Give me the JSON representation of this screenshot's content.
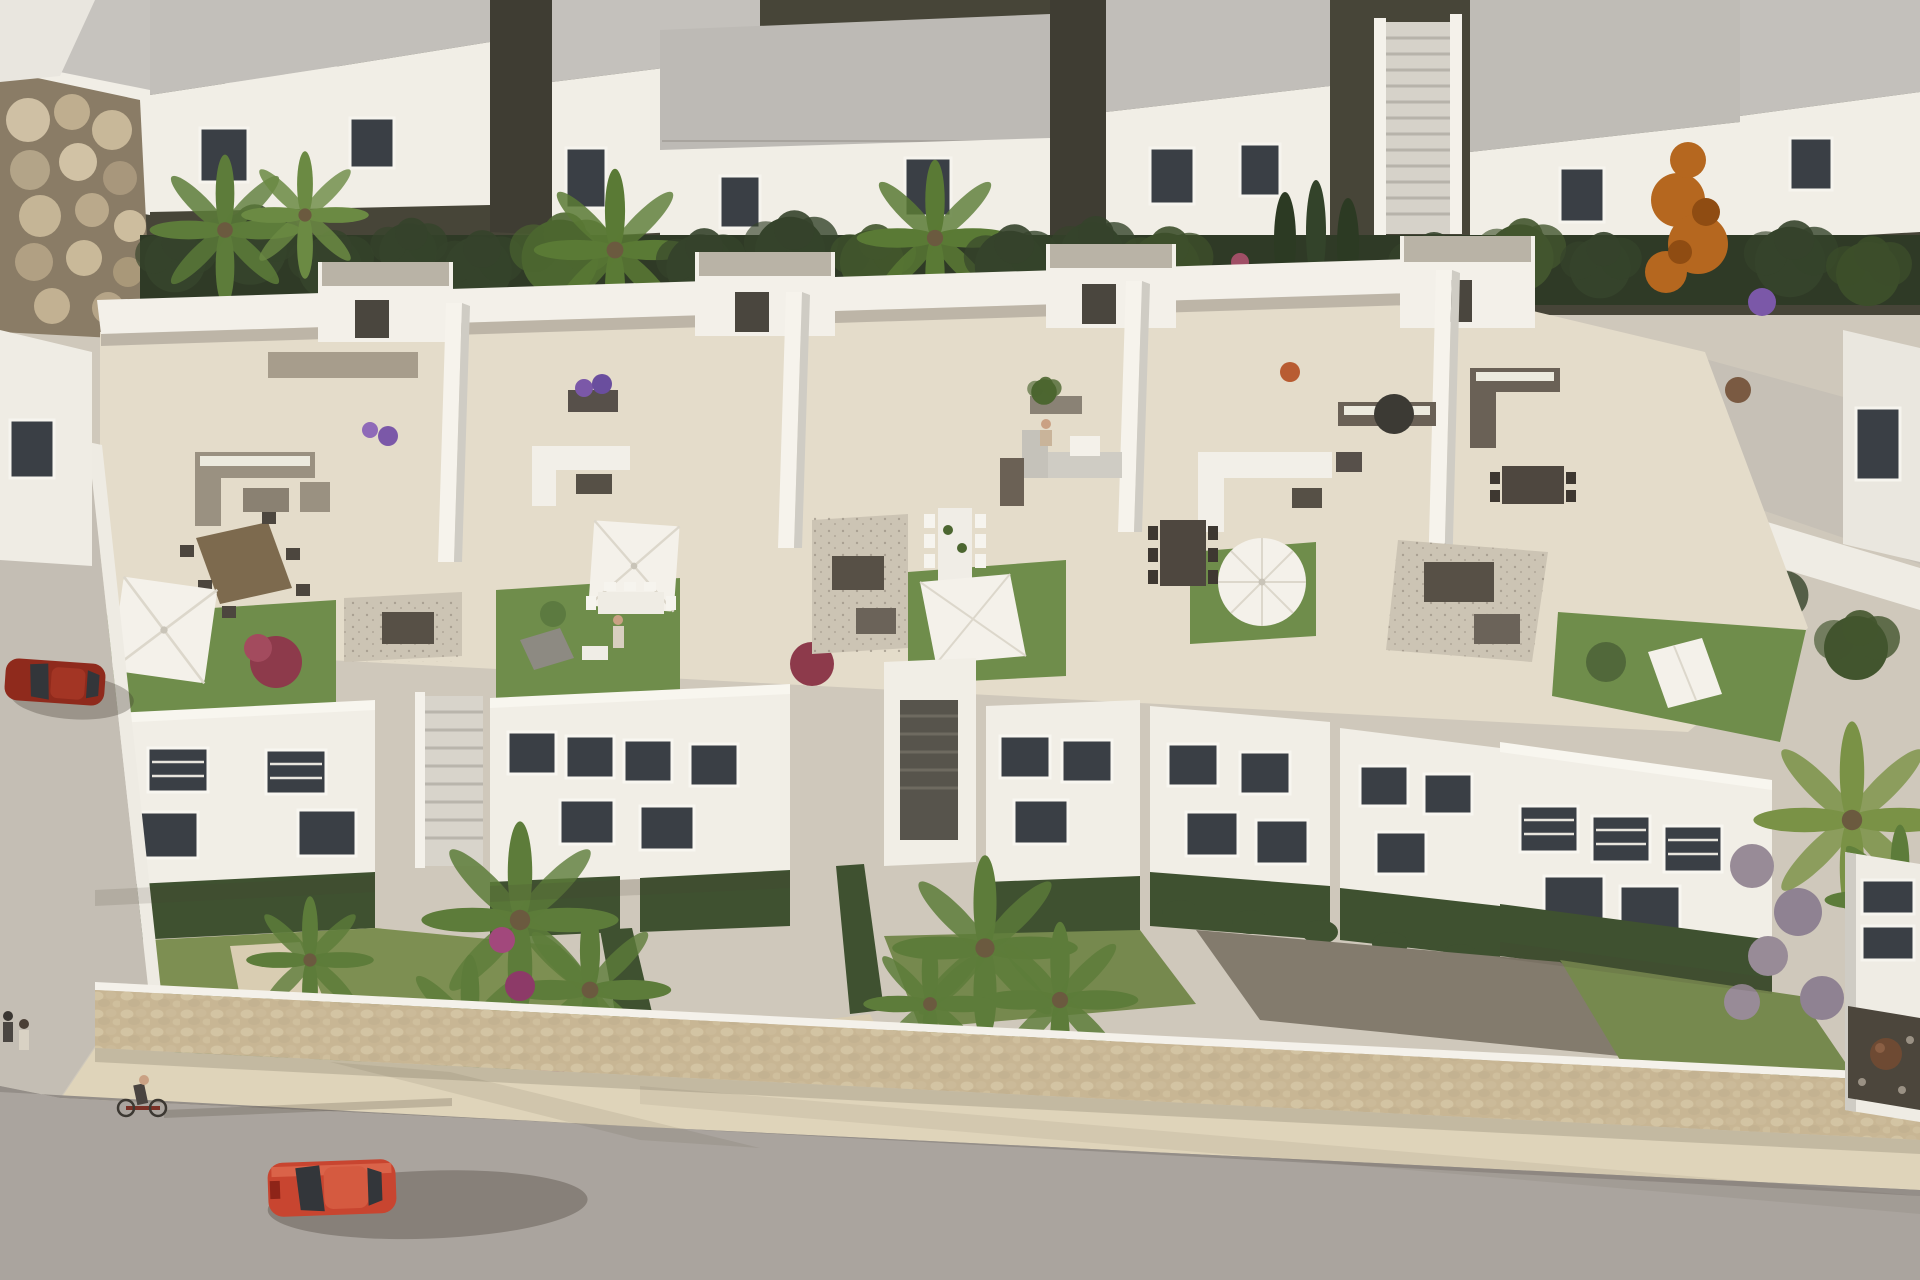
{
  "meta": {
    "title": "Aerial 3D render of a white townhouse development with rooftop terraces",
    "type": "architectural-visualization",
    "view": "aerial oblique, looking down at roof terraces, facades, gardens and street",
    "lighting": "low warm sun from upper-left, long shadows cast to the lower-right"
  },
  "palette": {
    "ground": "#cfc8bb",
    "white_sunlit": "#f1eee6",
    "white_bright": "#f8f6ef",
    "white_shade": "#d3d0c9",
    "white_deep_shade": "#bab7b0",
    "roof_gray": "#bfbcb6",
    "alley_dark": "#45443a",
    "terrace_pavement": "#e4dcca",
    "gravel": "#ccc4b4",
    "gravel_dark": "#837b6d",
    "lawn": "#6f8d4b",
    "lawn_dry": "#7d8f52",
    "garden_green": "#76894e",
    "hedge": "#3f5130",
    "tree_dark": "#35432b",
    "palm_green": "#5d7c3a",
    "cypress": "#2c3a23",
    "orange_tree": "#b5671f",
    "purple": "#7b58a8",
    "magenta": "#a2487c",
    "mauve": "#988b97",
    "stone_wall": "#c8b694",
    "sidewalk": "#dfd4ba",
    "stone_path": "#d9cdb2",
    "road": "#aaa49e",
    "left_street": "#c4beb4",
    "window_dark": "#3a3f45",
    "car_red": "#c84530",
    "car_red_dark": "#8f2a1c",
    "white_fabric": "#f4f1ea",
    "wood": "#7d6a4e",
    "furniture_dark": "#565046",
    "furniture_taupe": "#9a9181",
    "terracotta": "#6e4a33"
  },
  "scene": {
    "rear_row": {
      "buildings": 6,
      "features": [
        "flat gray roofs",
        "white facades",
        "dark framed windows",
        "two exterior staircases",
        "dark side alleys",
        "rock boulder wall at far left"
      ]
    },
    "tree_band": {
      "items": [
        "palm trees",
        "banana plants",
        "cypress hedge columns",
        "orange autumn tree",
        "purple shrubs",
        "pink flowering bushes"
      ]
    },
    "terrace_block": {
      "party_walls": 4,
      "units": [
        {
          "id": 1,
          "furniture": [
            "taupe lounge sofa set",
            "wooden dining table with eight chairs",
            "square white parasol",
            "gravel patch with storage box",
            "front lawn with red bush"
          ]
        },
        {
          "id": 2,
          "furniture": [
            "white lounge sofa",
            "dark coffee table",
            "square white parasol",
            "white dining table",
            "front lawn with gray lounger",
            "standing figure",
            "purple flower planter"
          ]
        },
        {
          "id": 3,
          "furniture": [
            "gray corner sofa with seated figure",
            "white coffee table",
            "white dining table with eight chairs",
            "pebble patch",
            "front lawn with shade sail",
            "planter boxes"
          ]
        },
        {
          "id": 4,
          "furniture": [
            "white corner sofa",
            "dark side tables",
            "round white parasol",
            "dark dining table with chairs",
            "blue flower planter"
          ]
        },
        {
          "id": 5,
          "furniture": [
            "charcoal sofa with white cushions",
            "closed dark parasol",
            "dark dining table",
            "pebble patio with planter boxes",
            "roof lawn with white double sun lounger"
          ]
        }
      ]
    },
    "street_level": {
      "facade_blocks": 5,
      "features": [
        "dark louvered windows",
        "recessed entrances",
        "external stair towers",
        "boxwood hedge rows"
      ],
      "gardens": [
        "palm garden left",
        "bougainvillea slope",
        "central palm garden",
        "mauve ball-bush garden right"
      ],
      "boundary": "natural stone retaining wall with pale sidewalk"
    },
    "road": {
      "vehicles": [
        {
          "name": "red car driving on main road",
          "color_key": "car_red"
        },
        {
          "name": "dark red car parked on left side street",
          "color_key": "car_red_dark"
        }
      ],
      "people": [
        {
          "name": "cyclist with long shadow"
        },
        {
          "name": "two pedestrians at left corner"
        },
        {
          "name": "figure standing on terrace lawn"
        },
        {
          "name": "figure seated on terrace sofa"
        }
      ]
    }
  }
}
